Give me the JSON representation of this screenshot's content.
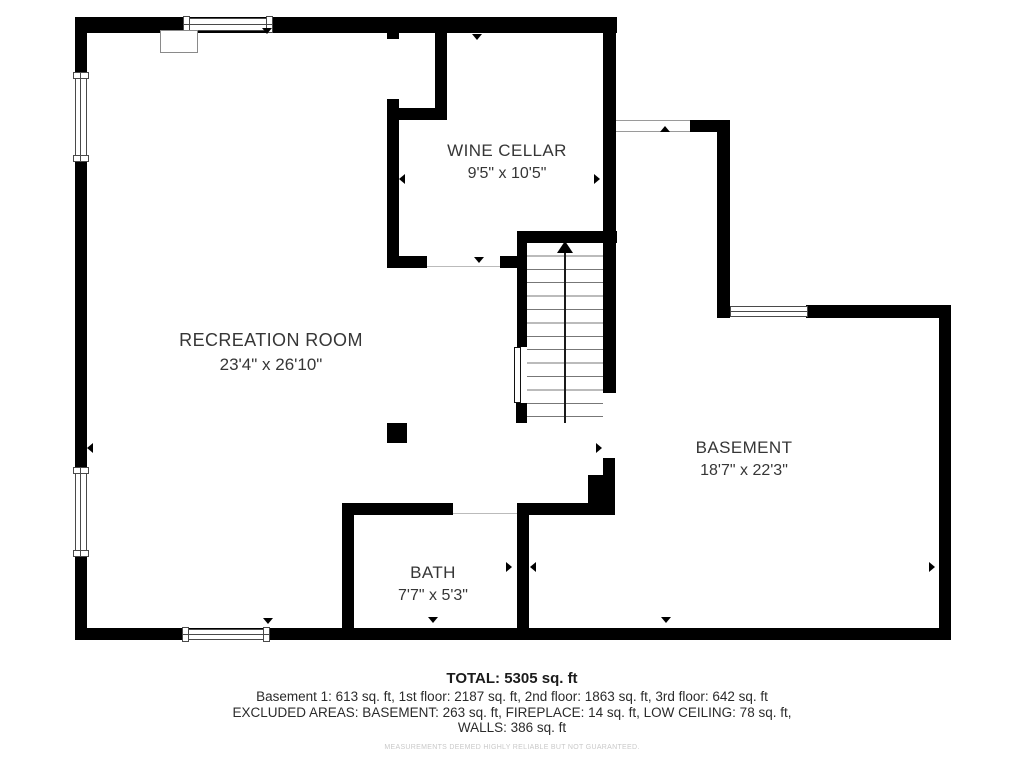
{
  "plan": {
    "rooms": [
      {
        "name": "WINE CELLAR",
        "dimensions": "9'5\" x 10'5\""
      },
      {
        "name": "RECREATION ROOM",
        "dimensions": "23'4\" x 26'10\""
      },
      {
        "name": "BASEMENT",
        "dimensions": "18'7\" x 22'3\""
      },
      {
        "name": "BATH",
        "dimensions": "7'7\" x 5'3\""
      }
    ]
  },
  "summary": {
    "total": "TOTAL: 5305 sq. ft",
    "floors": "Basement 1: 613 sq. ft, 1st floor: 2187 sq. ft, 2nd floor: 1863 sq. ft, 3rd floor: 642 sq. ft",
    "excluded_line1": "EXCLUDED AREAS: BASEMENT: 263 sq. ft, FIREPLACE: 14 sq. ft, LOW CEILING: 78 sq. ft,",
    "excluded_line2": "WALLS: 386 sq. ft",
    "disclaimer": "MEASUREMENTS DEEMED HIGHLY RELIABLE BUT NOT GUARANTEED."
  },
  "colors": {
    "wall": "#000000",
    "background": "#ffffff",
    "thin_line": "#4a4a4a",
    "label_text": "#363636",
    "disclaimer_text": "#c9c9c9"
  }
}
